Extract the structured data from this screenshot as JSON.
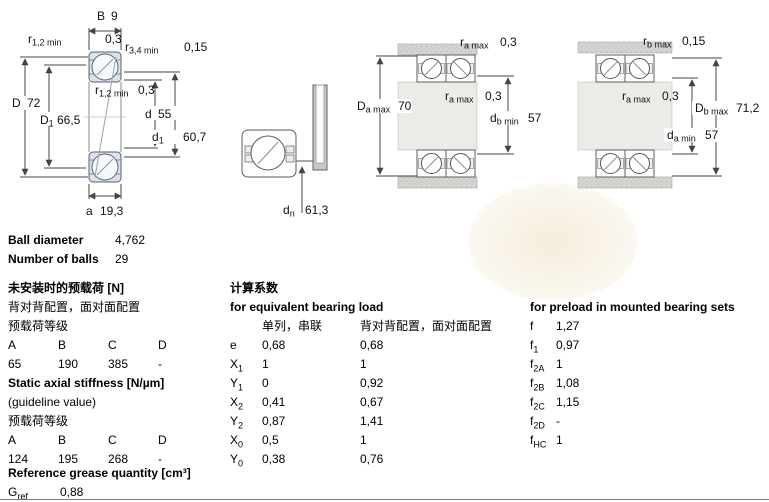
{
  "colors": {
    "bearing_ring_fill": "#dbe2ec",
    "housing_gray": "#d6d4d0",
    "shaft_gray": "#edebe7",
    "watermark_cream": "#f2e6cd",
    "line": "#4a4a4a"
  },
  "fig1": {
    "b_dim": {
      "sym": "B",
      "val": "9"
    },
    "r12_top": {
      "sym": "r",
      "sub": "1,2 min",
      "val": "0,3"
    },
    "r34": {
      "sym": "r",
      "sub": "3,4 min",
      "val": "0,15"
    },
    "D": {
      "sym": "D",
      "val": "72"
    },
    "D1": {
      "sym": "D",
      "sub": "1",
      "val": "66,5"
    },
    "r12_mid": {
      "sym": "r",
      "sub": "1,2 min",
      "val": "0,3"
    },
    "d": {
      "sym": "d",
      "val": "55"
    },
    "d1": {
      "sym": "d",
      "sub": "1",
      "val": "60,7"
    },
    "a": {
      "sym": "a",
      "val": "19,3"
    }
  },
  "fig2": {
    "dn": {
      "sym": "d",
      "sub": "n",
      "val": "61,3"
    }
  },
  "fig3": {
    "ra_top": {
      "sym": "r",
      "sub": "a max",
      "val": "0,3"
    },
    "Da": {
      "sym": "D",
      "sub": "a max",
      "val": "70"
    },
    "ra_mid": {
      "sym": "r",
      "sub": "a max",
      "val": "0,3"
    },
    "db": {
      "sym": "d",
      "sub": "b min",
      "val": "57"
    }
  },
  "fig4": {
    "rb_top": {
      "sym": "r",
      "sub": "b max",
      "val": "0,15"
    },
    "ra_mid": {
      "sym": "r",
      "sub": "a max",
      "val": "0,3"
    },
    "Db": {
      "sym": "D",
      "sub": "b max",
      "val": "71,2"
    },
    "da": {
      "sym": "d",
      "sub": "a min",
      "val": "57"
    }
  },
  "specs": {
    "rows": [
      {
        "label": "Ball diameter",
        "value": "4,762"
      },
      {
        "label": "Number of balls",
        "value": "29"
      }
    ]
  },
  "preload_unmounted": {
    "title": "未安装时的预载荷 [N]",
    "subtitle": "背对背配置，面对面配置",
    "grade_label": "预载荷等级",
    "headers": [
      "A",
      "B",
      "C",
      "D"
    ],
    "values": [
      "65",
      "190",
      "385",
      "-"
    ]
  },
  "stiffness": {
    "title": "Static axial stiffness [N/µm]",
    "subtitle": "(guideline value)",
    "grade_label": "预载荷等级",
    "headers": [
      "A",
      "B",
      "C",
      "D"
    ],
    "values": [
      "124",
      "195",
      "268",
      "-"
    ]
  },
  "grease": {
    "title": "Reference grease quantity [cm³]",
    "symbol": {
      "sym": "G",
      "sub": "ref"
    },
    "value": "0,88"
  },
  "calc": {
    "title": "计算系数",
    "equiv_title": "for equivalent bearing load",
    "col1_header": "单列，串联",
    "col2_header": "背对背配置，面对面配置",
    "rows": [
      {
        "sym": "e",
        "sub": "",
        "v1": "0,68",
        "v2": "0,68"
      },
      {
        "sym": "X",
        "sub": "1",
        "v1": "1",
        "v2": "1"
      },
      {
        "sym": "Y",
        "sub": "1",
        "v1": "0",
        "v2": "0,92"
      },
      {
        "sym": "X",
        "sub": "2",
        "v1": "0,41",
        "v2": "0,67"
      },
      {
        "sym": "Y",
        "sub": "2",
        "v1": "0,87",
        "v2": "1,41"
      },
      {
        "sym": "X",
        "sub": "0",
        "v1": "0,5",
        "v2": "1"
      },
      {
        "sym": "Y",
        "sub": "0",
        "v1": "0,38",
        "v2": "0,76"
      }
    ]
  },
  "preload_factors": {
    "title": "for preload in mounted bearing sets",
    "rows": [
      {
        "sym": "f",
        "sub": "",
        "val": "1,27"
      },
      {
        "sym": "f",
        "sub": "1",
        "val": "0,97"
      },
      {
        "sym": "f",
        "sub": "2A",
        "val": "1"
      },
      {
        "sym": "f",
        "sub": "2B",
        "val": "1,08"
      },
      {
        "sym": "f",
        "sub": "2C",
        "val": "1,15"
      },
      {
        "sym": "f",
        "sub": "2D",
        "val": "-"
      },
      {
        "sym": "f",
        "sub": "HC",
        "val": "1"
      }
    ]
  }
}
